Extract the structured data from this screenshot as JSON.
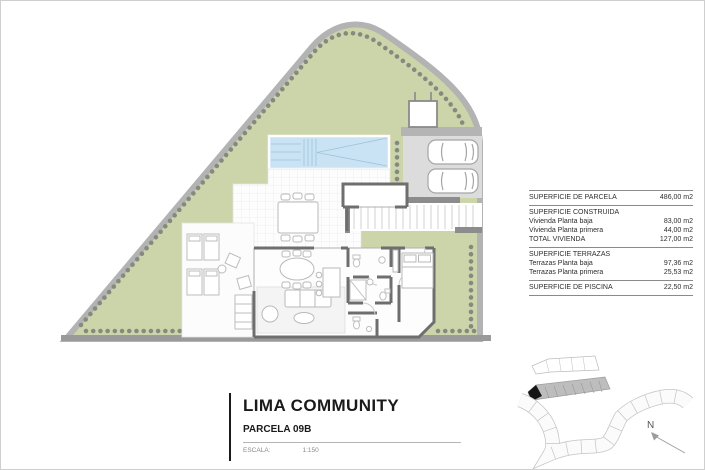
{
  "title_block": {
    "title": "LIMA COMMUNITY",
    "subtitle": "PARCELA 09B",
    "scale_label": "ESCALA:",
    "scale_value": "1:150"
  },
  "areas_table": {
    "sections": [
      {
        "rows": [
          {
            "label": "SUPERFICIE DE PARCELA",
            "value": "486,00 m2"
          }
        ]
      },
      {
        "header": "SUPERFICIE CONSTRUIDA",
        "rows": [
          {
            "label": "Vivienda Planta baja",
            "value": "83,00 m2"
          },
          {
            "label": "Vivienda Planta primera",
            "value": "44,00 m2"
          },
          {
            "label": "TOTAL VIVIENDA",
            "value": "127,00 m2"
          }
        ]
      },
      {
        "header": "SUPERFICIE TERRAZAS",
        "rows": [
          {
            "label": "Terrazas Planta baja",
            "value": "97,36 m2"
          },
          {
            "label": "Terrazas Planta primera",
            "value": "25,53 m2"
          }
        ]
      },
      {
        "rows": [
          {
            "label": "SUPERFICIE DE PISCINA",
            "value": "22,50 m2"
          }
        ]
      }
    ]
  },
  "site_plan": {
    "north_label": "N",
    "highlighted_parcel": "09B",
    "colors": {
      "grass": "#ccd4a9",
      "boundary": "#b3b3b3",
      "hedge_dot": "#858a80",
      "pool_water": "#c9e3f4",
      "wall": "#6e6e6e",
      "paving": "#dcdcdc",
      "minimap_strip": "#bdbdbd",
      "highlight": "#151515"
    }
  }
}
